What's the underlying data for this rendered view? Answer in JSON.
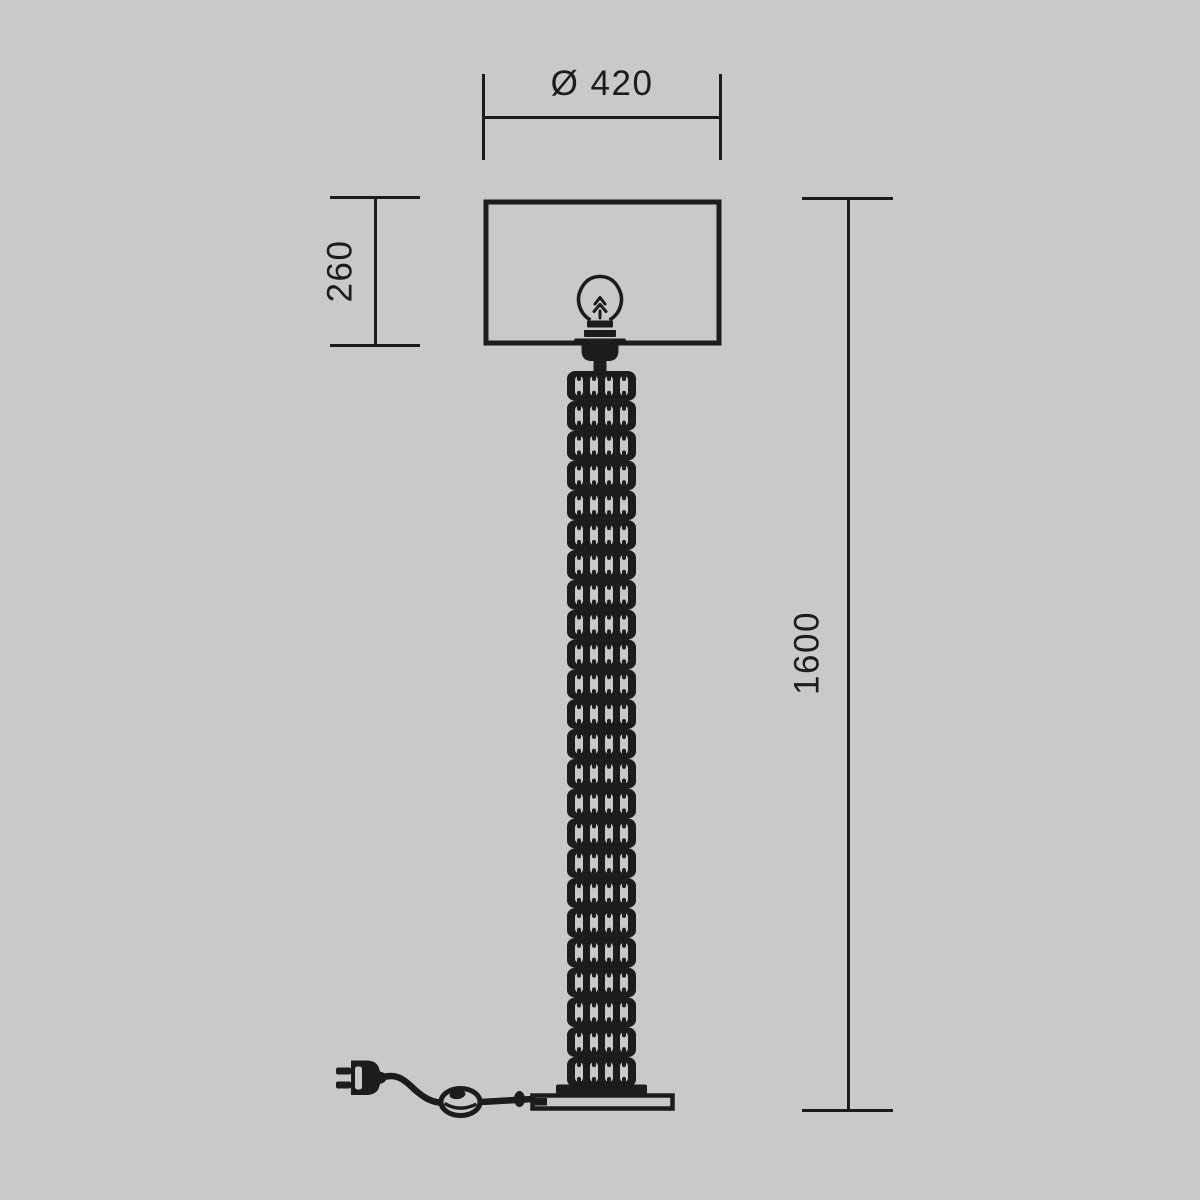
{
  "colors": {
    "background": "#c9c9c9",
    "ink": "#1c1c1c"
  },
  "drawing": {
    "type": "technical-dimension-drawing",
    "subject": "floor-lamp",
    "dimensions": {
      "diameter": {
        "label": "Ø 420"
      },
      "shade_height": {
        "label": "260"
      },
      "total_height": {
        "label": "1600"
      }
    },
    "parts": [
      "lampshade",
      "light-bulb",
      "crystal-column",
      "base-plate",
      "power-cord",
      "foot-switch",
      "power-plug"
    ]
  }
}
